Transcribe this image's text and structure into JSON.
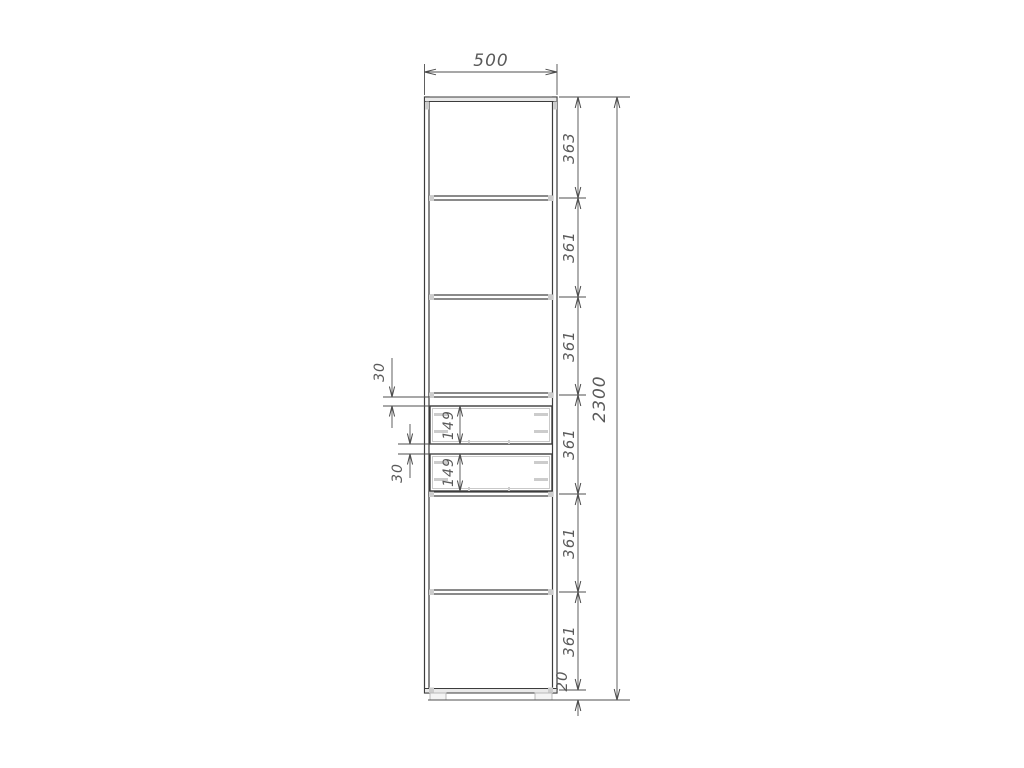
{
  "drawing": {
    "title": "cabinet-front-elevation-technical-drawing",
    "width_mm": "500",
    "height_mm": "2300",
    "sections_mm": [
      "363",
      "361",
      "361",
      "361",
      "361",
      "361"
    ],
    "plinth_mm": "20",
    "drawer_gaps_mm": [
      "30",
      "30"
    ],
    "drawer_heights_mm": [
      "149",
      "149"
    ],
    "colors": {
      "background": "#ffffff",
      "main_lines": "#3c3c3c",
      "dimension_lines": "#4f4f4f",
      "hardware_gray": "#cccccc",
      "text": "#5a5a5a"
    }
  }
}
